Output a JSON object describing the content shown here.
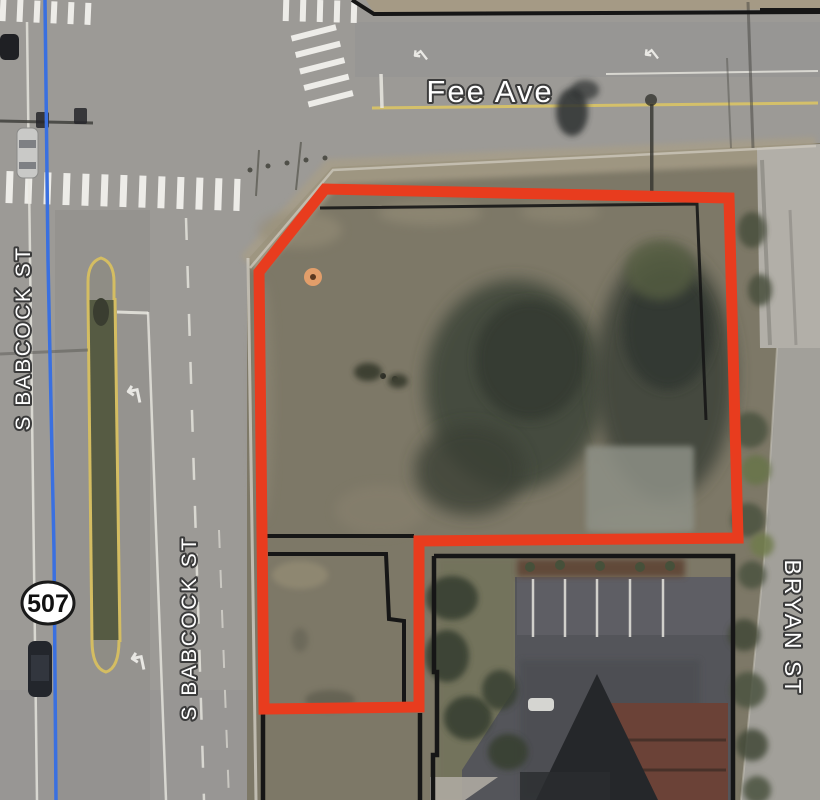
{
  "map": {
    "labels": {
      "fee_ave": "Fee Ave",
      "babcock_north": "S BABCOCK ST",
      "babcock_south": "S BABCOCK ST",
      "bryan": "BRYAN ST"
    },
    "route_shield": {
      "number": "507"
    },
    "icons": {
      "turn_arrow_glyph": "↰"
    },
    "colors": {
      "parcel_highlight_red": "#e83c1e",
      "parcel_boundary_black": "#161616",
      "road_centerline_blue": "#3a70e0",
      "street_label_fill": "#ffffff",
      "street_label_halo": "#3b3b3b",
      "lane_yellow": "#d4bd62",
      "shield_fill": "#ffffff",
      "shield_border": "#1a1a1a",
      "shield_text": "#111111",
      "site_marker_orange": "#e8a06a"
    }
  }
}
